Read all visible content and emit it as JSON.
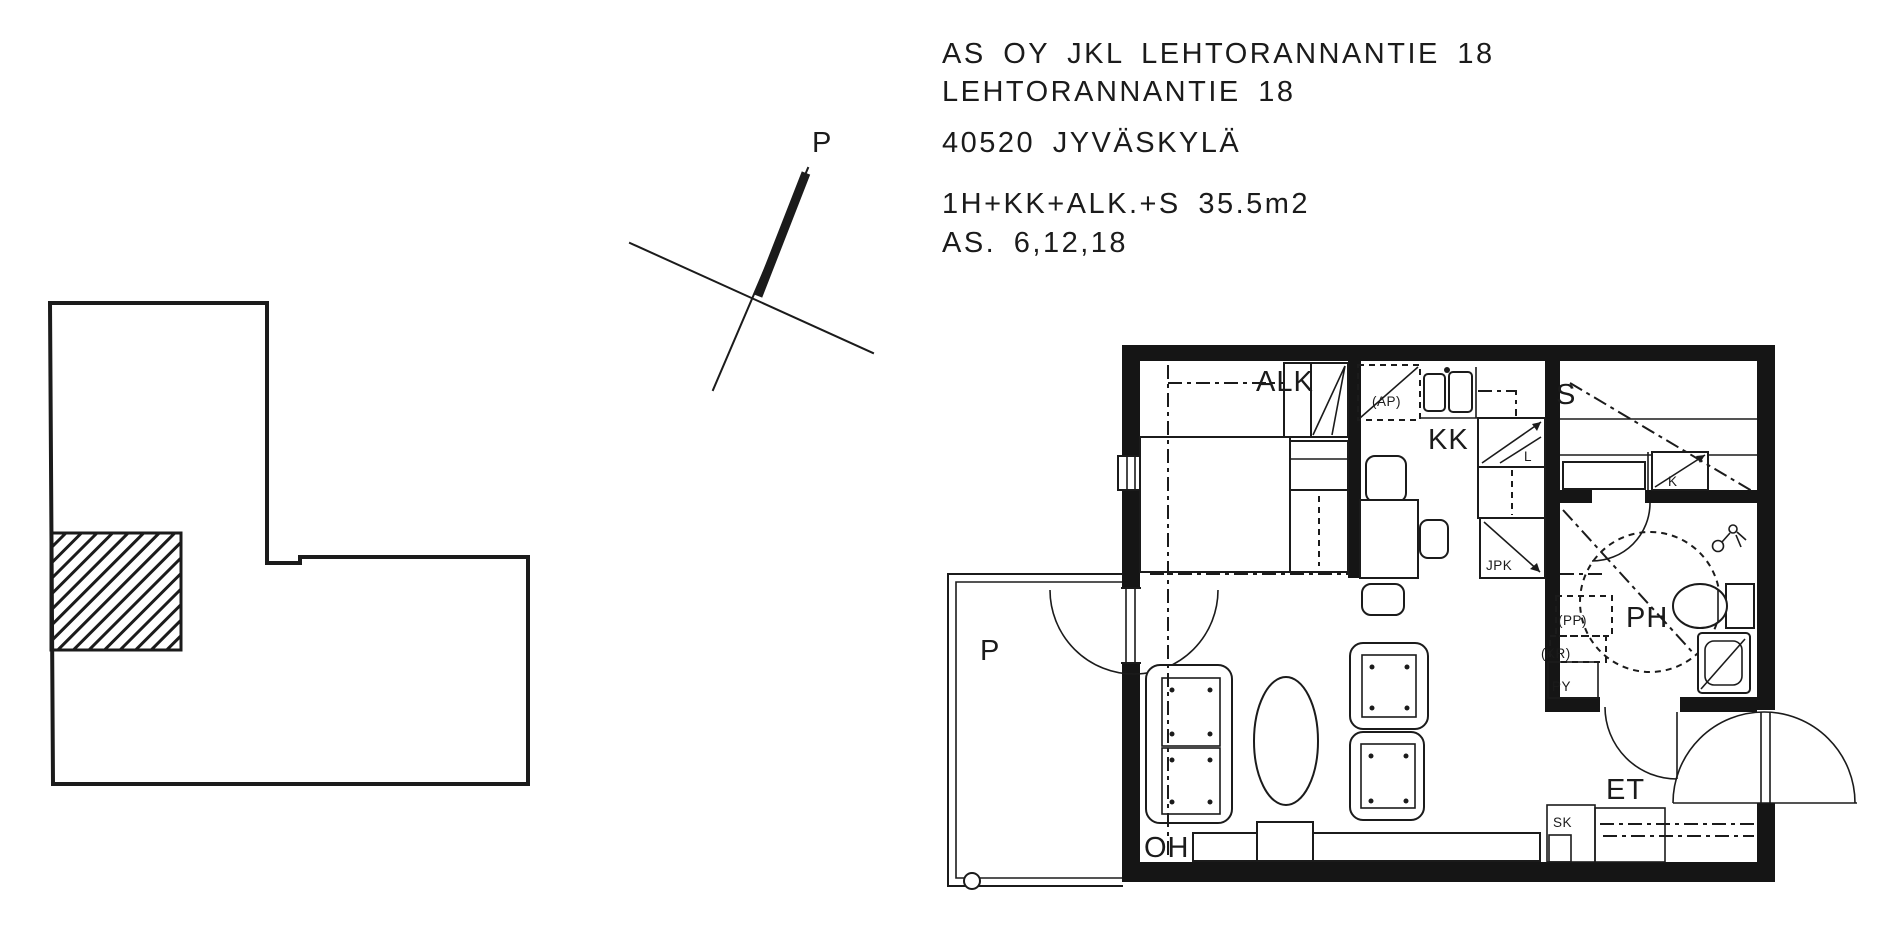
{
  "header": {
    "company": "AS OY JKL LEHTORANNANTIE 18",
    "street": "LEHTORANNANTIE 18",
    "city": "40520 JYVÄSKYLÄ",
    "apartment_type": "1H+KK+ALK.+S 35.5m2",
    "apartment_numbers": "AS. 6,12,18"
  },
  "compass": {
    "north": "P"
  },
  "rooms": {
    "alcove": "ALK",
    "kitchenette": "KK",
    "sauna": "S",
    "bathroom": "PH",
    "entry": "ET",
    "living_room": "OH",
    "balcony": "P"
  },
  "fixtures": {
    "dishwasher": "(AP)",
    "stove": "L",
    "fridge_freezer": "JPK",
    "sauna_heater": "K",
    "washer": "(PP)",
    "dryer": "(KR)",
    "laundry_cabinet": "PY",
    "cleaning_closet": "SK"
  },
  "colors": {
    "ink": "#1b1b1b",
    "paper": "#ffffff"
  }
}
